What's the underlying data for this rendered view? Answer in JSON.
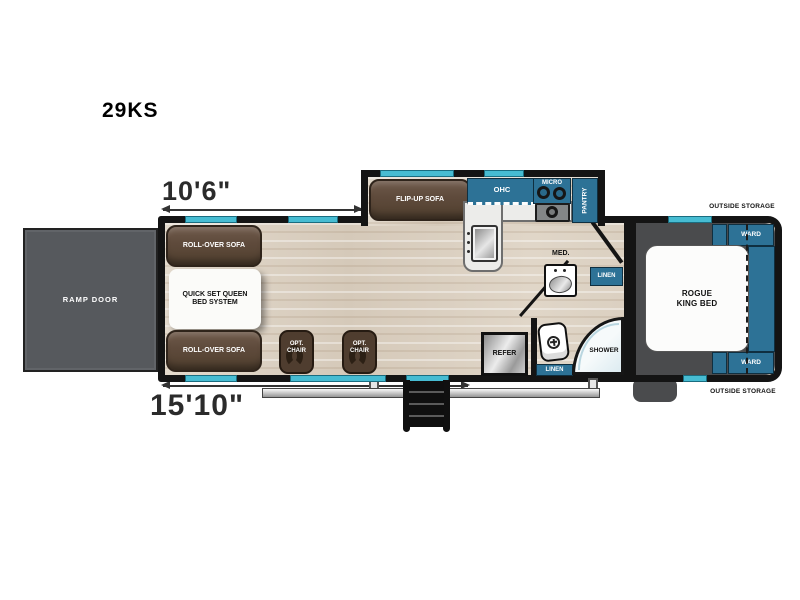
{
  "model": "29KS",
  "dims": {
    "garage_width": "10'6\"",
    "garage_length": "15'10\""
  },
  "colors": {
    "cabinet_teal": "#2d7296",
    "window_cyan": "#47bcd2",
    "sofa_brown": "#5c4839",
    "floor_wood": "#d9cec0",
    "bedroom_floor_gray": "#4a4b4d",
    "ramp_door_gray": "#56595d",
    "wall_black": "#141414"
  },
  "garage": {
    "ramp_door": "RAMP DOOR",
    "roll_over_sofa_top": "ROLL-OVER SOFA",
    "queen_bed": "QUICK SET QUEEN\nBED SYSTEM",
    "roll_over_sofa_bottom": "ROLL-OVER SOFA",
    "opt_chair_1": "OPT.\nCHAIR",
    "opt_chair_2": "OPT.\nCHAIR"
  },
  "kitchen": {
    "flip_up_sofa": "FLIP-UP SOFA",
    "ohc": "OHC",
    "micro": "MICRO",
    "pantry": "PANTRY",
    "refer": "REFER"
  },
  "bath": {
    "med": "MED.",
    "linen_upper": "LINEN",
    "linen_lower": "LINEN",
    "shower": "SHOWER"
  },
  "bedroom": {
    "bed": "ROGUE\nKING BED",
    "ward_top": "WARD",
    "ward_bottom": "WARD",
    "outside_storage_top": "OUTSIDE STORAGE",
    "outside_storage_bottom": "OUTSIDE STORAGE"
  }
}
